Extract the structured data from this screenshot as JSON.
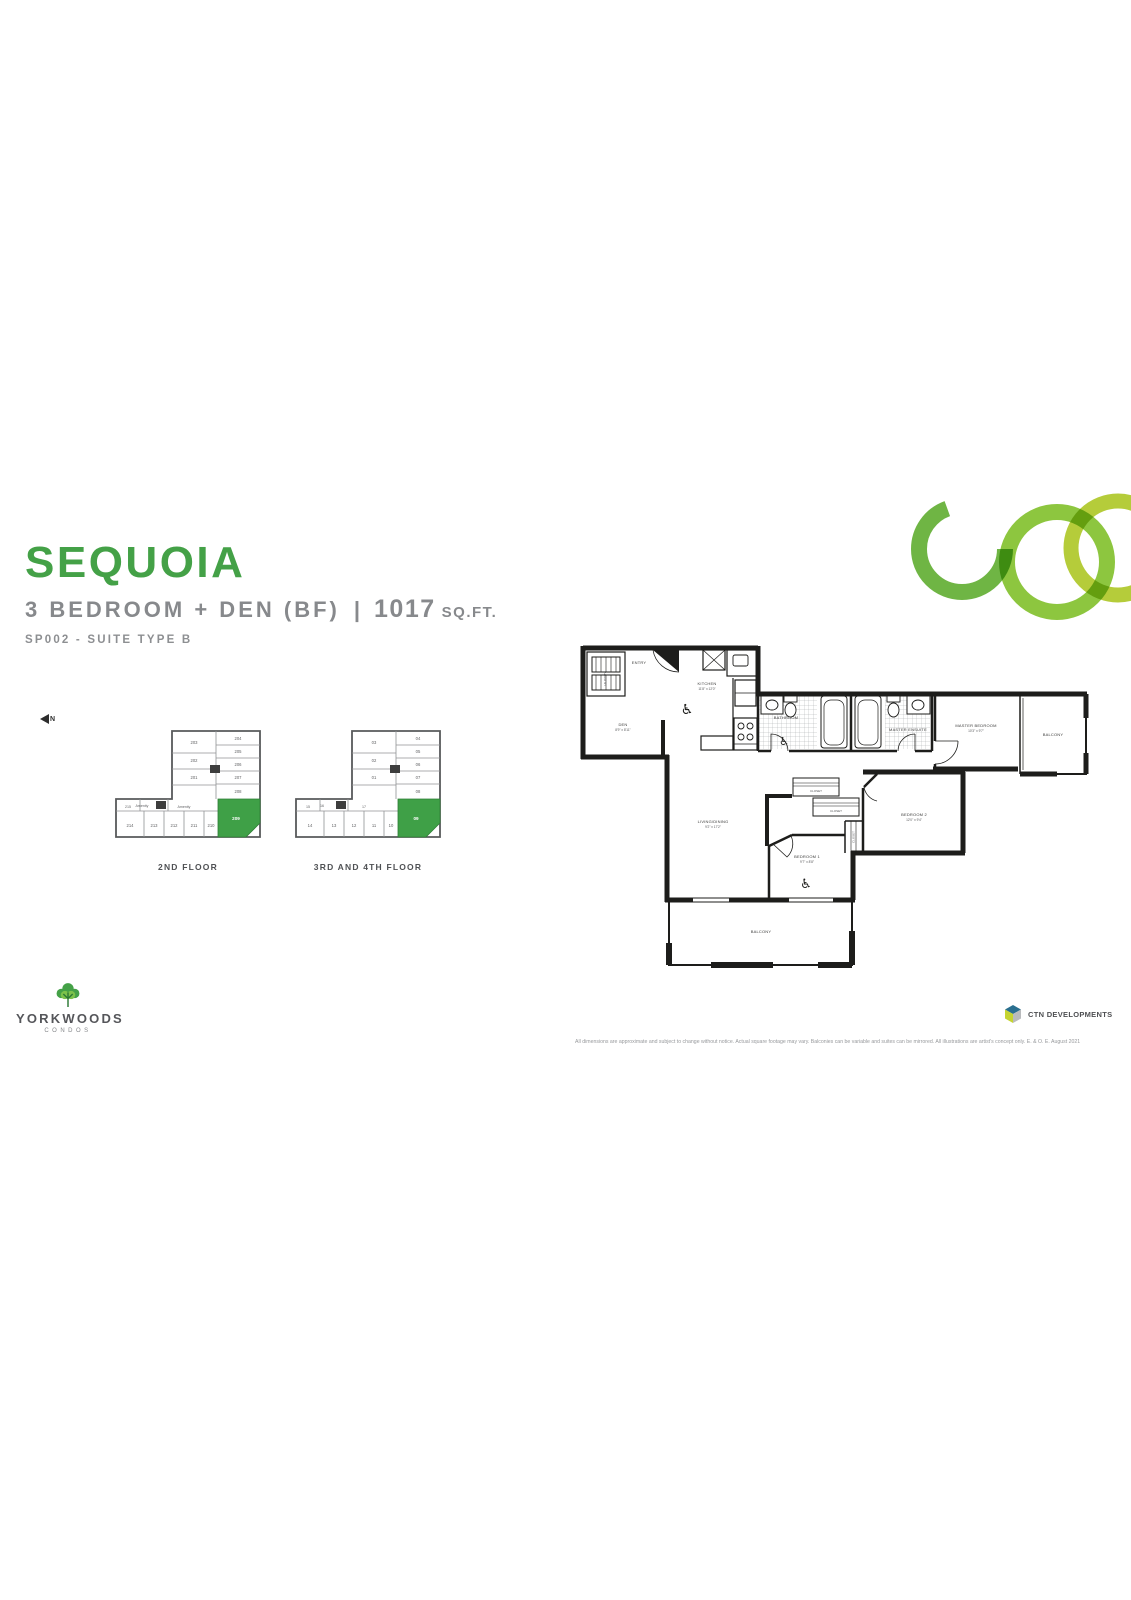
{
  "header": {
    "title": "SEQUOIA",
    "subtitle": "3 BEDROOM + DEN (BF)",
    "divider": "|",
    "area_value": "1017",
    "area_unit": "SQ.FT.",
    "suite_code": "SP002 - SUITE TYPE B"
  },
  "north_indicator": {
    "label": "N"
  },
  "key_plans": [
    {
      "caption": "2ND FLOOR",
      "highlight_label": "209",
      "tower_left": [
        "203",
        "202",
        "201"
      ],
      "tower_right": [
        "204",
        "205",
        "206",
        "207",
        "208"
      ],
      "bottom_row": [
        "214",
        "213",
        "212",
        "211",
        "210"
      ],
      "side": "215",
      "mid": [
        "Amenity",
        "Amenity"
      ]
    },
    {
      "caption": "3RD AND 4TH FLOOR",
      "highlight_label": "09",
      "tower_left": [
        "03",
        "02",
        "01"
      ],
      "tower_right": [
        "04",
        "05",
        "06",
        "07",
        "08"
      ],
      "bottom_row": [
        "14",
        "13",
        "12",
        "11",
        "10"
      ],
      "side": "15",
      "mid": [
        "16",
        "17"
      ]
    }
  ],
  "floor_plan": {
    "accessibility_symbol": "♿",
    "laundry": {
      "name": "LAUNDRY"
    },
    "entry": {
      "name": "ENTRY"
    },
    "den": {
      "name": "DEN",
      "dims": "8'9\" x 8'11\""
    },
    "kitchen": {
      "name": "KITCHEN",
      "dims": "11'8\" x 12'0\""
    },
    "bathroom": {
      "name": "BATHROOM"
    },
    "master_ensuite": {
      "name": "MASTER ENSUITE"
    },
    "master_bedroom": {
      "name": "MASTER BEDROOM",
      "dims": "10'3\" x 9'7\""
    },
    "balcony_right": {
      "name": "BALCONY"
    },
    "living_dining": {
      "name": "LIVING/DINING",
      "dims": "9'2\" x 17'2\""
    },
    "closet_a": {
      "name": "CLOSET"
    },
    "closet_b": {
      "name": "CLOSET"
    },
    "closet_c": {
      "name": "CLOSET"
    },
    "bedroom_1": {
      "name": "BEDROOM 1",
      "dims": "9'7\" x 8'8\""
    },
    "bedroom_2": {
      "name": "BEDROOM 2",
      "dims": "12'0\" x 9'4\""
    },
    "balcony_bottom": {
      "name": "BALCONY"
    }
  },
  "branding": {
    "yorkwoods": {
      "name": "YORKWOODS",
      "tagline": "CONDOS"
    },
    "ctn": {
      "name": "CTN DEVELOPMENTS"
    }
  },
  "disclaimer": "All dimensions are approximate and subject to change without notice. Actual square footage may vary. Balconies can be variable and suites can be mirrored. All illustrations are artist's concept only. E. & O. E. August 2021",
  "colors": {
    "accent_green": "#44a147",
    "highlight_green": "#3fa047",
    "ring_green_dark": "#6fb544",
    "ring_green_mid": "#8dc63f",
    "ring_green_light": "#b5cc3a",
    "wall": "#1d1d1b",
    "text_gray": "#87898c"
  }
}
